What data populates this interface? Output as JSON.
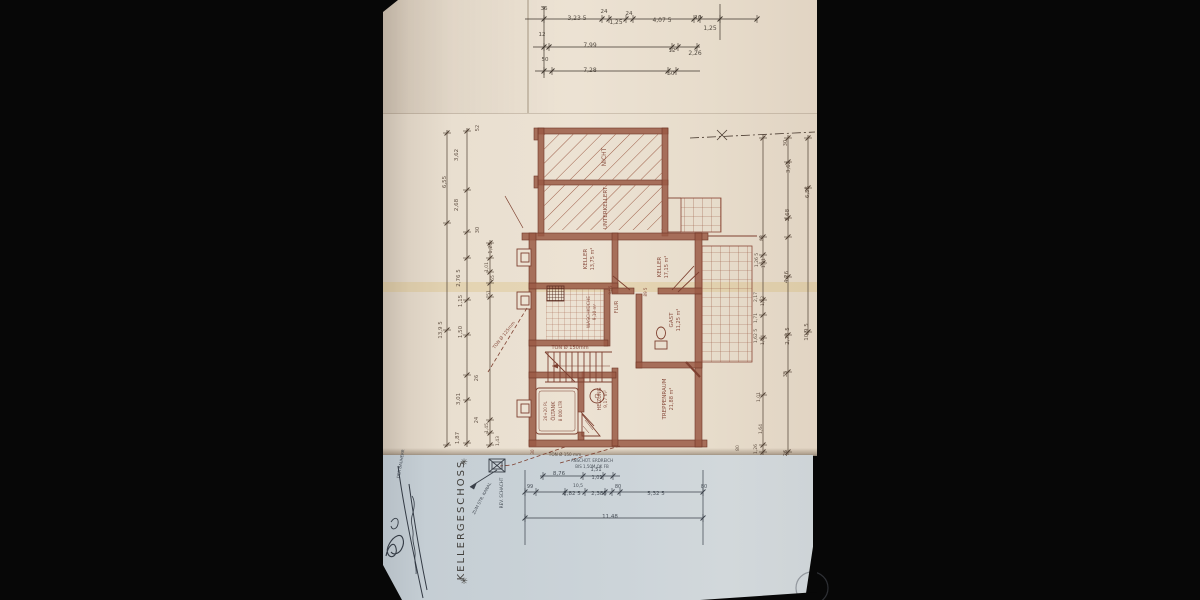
{
  "scene": {
    "description": "Photograph of a hand-drawn basement floor plan (Kellergeschoss), drawing rotated 90 degrees on the sheet",
    "paper_color": "#e9dfd0",
    "lower_sheet_color": "#ccd4d9",
    "plan_ink_color": "#8a4636",
    "dimension_ink_color": "#4e3e31",
    "lower_ink_color": "#383f48",
    "background_color": "#070707"
  },
  "plan": {
    "title": "KELLERGESCHOSS",
    "star": "✳",
    "rooms_summary": [
      {
        "label": "NICHT UNTERKELLERT",
        "note": "two hatched unexcavated areas"
      },
      {
        "label": "KELLER",
        "area": "13,75 m²"
      },
      {
        "label": "KELLER",
        "area": "17,15 m²"
      },
      {
        "label": "WASCHKÜCHE",
        "area": "9,10 m²"
      },
      {
        "label": "FLUR"
      },
      {
        "label": "GAST",
        "area": "11,25 m²"
      },
      {
        "label": "TREPPENRAUM",
        "area": "21,88 m²"
      },
      {
        "label": "HEIZUNG",
        "area": "9,17 m²"
      },
      {
        "label": "ÖLTANK",
        "note": "8 000 LTR"
      }
    ],
    "labels": [
      {
        "t": "36",
        "x": 544,
        "y": 10,
        "k": "top",
        "s": 5.5
      },
      {
        "t": "3,23 5",
        "x": 577,
        "y": 20,
        "k": "top",
        "s": 6
      },
      {
        "t": "24",
        "x": 604,
        "y": 13,
        "k": "top",
        "s": 5.5
      },
      {
        "t": "1,25",
        "x": 616,
        "y": 24,
        "k": "top",
        "s": 6
      },
      {
        "t": "24",
        "x": 629,
        "y": 15,
        "k": "top",
        "s": 5.5
      },
      {
        "t": "4,07 5",
        "x": 662,
        "y": 22,
        "k": "top",
        "s": 6
      },
      {
        "t": "10",
        "x": 698,
        "y": 19,
        "k": "top",
        "s": 5.5
      },
      {
        "t": "1,25",
        "x": 710,
        "y": 30,
        "k": "top",
        "s": 6
      },
      {
        "t": "12",
        "x": 542,
        "y": 36,
        "k": "top",
        "s": 5.5
      },
      {
        "t": "7,99",
        "x": 590,
        "y": 47,
        "k": "top",
        "s": 6
      },
      {
        "t": "12",
        "x": 672,
        "y": 52,
        "k": "top",
        "s": 5.5
      },
      {
        "t": "2,26",
        "x": 695,
        "y": 55,
        "k": "top",
        "s": 6
      },
      {
        "t": "50",
        "x": 545,
        "y": 61,
        "k": "top",
        "s": 5.5
      },
      {
        "t": "7,28",
        "x": 590,
        "y": 72,
        "k": "top",
        "s": 6
      },
      {
        "t": "50",
        "x": 671,
        "y": 75,
        "k": "top",
        "s": 5.5
      },
      {
        "t": "52",
        "x": 479,
        "y": 128,
        "r": -90,
        "k": "dim",
        "s": 5
      },
      {
        "t": "3,62",
        "x": 458,
        "y": 155,
        "r": -90,
        "k": "dim",
        "s": 5.5
      },
      {
        "t": "6,55",
        "x": 446,
        "y": 182,
        "r": -90,
        "k": "dim",
        "s": 5.5
      },
      {
        "t": "2,68",
        "x": 458,
        "y": 205,
        "r": -90,
        "k": "dim",
        "s": 5.5
      },
      {
        "t": "30",
        "x": 479,
        "y": 230,
        "r": -90,
        "k": "dim",
        "s": 5
      },
      {
        "t": "1,25",
        "x": 492,
        "y": 248,
        "r": -90,
        "k": "dim",
        "s": 5
      },
      {
        "t": "1,01",
        "x": 488,
        "y": 267,
        "r": -90,
        "k": "dim",
        "s": 4.5
      },
      {
        "t": "65",
        "x": 494,
        "y": 278,
        "r": -90,
        "k": "dim",
        "s": 4.5
      },
      {
        "t": "2,76 5",
        "x": 460,
        "y": 278,
        "r": -90,
        "k": "dim",
        "s": 5.5
      },
      {
        "t": "51",
        "x": 490,
        "y": 293,
        "r": -90,
        "k": "dim",
        "s": 4.5
      },
      {
        "t": "1,15",
        "x": 462,
        "y": 301,
        "r": -90,
        "k": "dim",
        "s": 5.5
      },
      {
        "t": "13,9 5",
        "x": 442,
        "y": 330,
        "r": -90,
        "k": "dim",
        "s": 5.5
      },
      {
        "t": "1,50",
        "x": 462,
        "y": 332,
        "r": -90,
        "k": "dim",
        "s": 5.5
      },
      {
        "t": "26",
        "x": 478,
        "y": 378,
        "r": -90,
        "k": "dim",
        "s": 5
      },
      {
        "t": "3,01",
        "x": 460,
        "y": 399,
        "r": -90,
        "k": "dim",
        "s": 5.5
      },
      {
        "t": "24",
        "x": 478,
        "y": 420,
        "r": -90,
        "k": "dim",
        "s": 5
      },
      {
        "t": "1,87",
        "x": 459,
        "y": 438,
        "r": -90,
        "k": "dim",
        "s": 5.5
      },
      {
        "t": "1,45",
        "x": 488,
        "y": 428,
        "r": -90,
        "k": "dim",
        "s": 4.5
      },
      {
        "t": "1,43",
        "x": 499,
        "y": 441,
        "r": -90,
        "k": "dim",
        "s": 4.5
      },
      {
        "t": "30",
        "x": 787,
        "y": 143,
        "r": -90,
        "k": "dim",
        "s": 5
      },
      {
        "t": "3,62",
        "x": 790,
        "y": 167,
        "r": -90,
        "k": "dim",
        "s": 5.5
      },
      {
        "t": "6,55",
        "x": 809,
        "y": 192,
        "r": -90,
        "k": "dim",
        "s": 5.5
      },
      {
        "t": "2,68",
        "x": 789,
        "y": 215,
        "r": -90,
        "k": "dim",
        "s": 5.5
      },
      {
        "t": "88",
        "x": 763,
        "y": 238,
        "r": -90,
        "k": "dim",
        "s": 4.5
      },
      {
        "t": "1,26 5",
        "x": 758,
        "y": 260,
        "r": -90,
        "k": "dim",
        "s": 4.5
      },
      {
        "t": "1,31",
        "x": 765,
        "y": 263,
        "r": -90,
        "k": "dim",
        "s": 4.5
      },
      {
        "t": "4,26",
        "x": 788,
        "y": 277,
        "r": -90,
        "k": "dim",
        "s": 5.5
      },
      {
        "t": "2,17",
        "x": 757,
        "y": 297,
        "r": -90,
        "k": "dim",
        "s": 4.5
      },
      {
        "t": "1,32",
        "x": 764,
        "y": 301,
        "r": -90,
        "k": "dim",
        "s": 4.5
      },
      {
        "t": "1,71",
        "x": 757,
        "y": 318,
        "r": -90,
        "k": "dim",
        "s": 4.5
      },
      {
        "t": "1,62 5",
        "x": 757,
        "y": 336,
        "r": -90,
        "k": "dim",
        "s": 4.5
      },
      {
        "t": "1,04",
        "x": 764,
        "y": 340,
        "r": -90,
        "k": "dim",
        "s": 4.5
      },
      {
        "t": "2,78 5",
        "x": 789,
        "y": 336,
        "r": -90,
        "k": "dim",
        "s": 5.5
      },
      {
        "t": "10,9 5",
        "x": 808,
        "y": 332,
        "r": -90,
        "k": "dim",
        "s": 5.5
      },
      {
        "t": "35",
        "x": 787,
        "y": 374,
        "r": -90,
        "k": "dim",
        "s": 5
      },
      {
        "t": "1,01",
        "x": 760,
        "y": 397,
        "r": -90,
        "k": "dim",
        "s": 4.5
      },
      {
        "t": "1,64",
        "x": 762,
        "y": 429,
        "r": -90,
        "k": "dim",
        "s": 4.5
      },
      {
        "t": "1,26",
        "x": 757,
        "y": 449,
        "r": -90,
        "k": "dim",
        "s": 4.5
      },
      {
        "t": "26",
        "x": 787,
        "y": 453,
        "r": -90,
        "k": "dim",
        "s": 5
      },
      {
        "t": "80",
        "x": 739,
        "y": 448,
        "r": -90,
        "k": "dim",
        "s": 4.5
      },
      {
        "t": "NICHT",
        "x": 606,
        "y": 157,
        "r": -90,
        "k": "plan",
        "s": 6,
        "n": "room-label-nicht"
      },
      {
        "t": "UNTERKELLERT",
        "x": 607,
        "y": 208,
        "r": -90,
        "k": "plan",
        "s": 5.5,
        "n": "room-label-unterkellert"
      },
      {
        "t": "KELLER",
        "x": 587,
        "y": 259,
        "r": -90,
        "k": "plan",
        "s": 5.5,
        "n": "room-label-keller-1"
      },
      {
        "t": "13,75 m²",
        "x": 594,
        "y": 259,
        "r": -90,
        "k": "plan",
        "s": 5
      },
      {
        "t": "KELLER",
        "x": 661,
        "y": 267,
        "r": -90,
        "k": "plan",
        "s": 5.5,
        "n": "room-label-keller-2"
      },
      {
        "t": "17,15 m²",
        "x": 668,
        "y": 267,
        "r": -90,
        "k": "plan",
        "s": 5
      },
      {
        "t": "WASCHKÜCHE",
        "x": 590,
        "y": 312,
        "r": -90,
        "k": "plan",
        "s": 4.5,
        "n": "room-label-waschkueche"
      },
      {
        "t": "9,10 m²",
        "x": 596,
        "y": 312,
        "r": -90,
        "k": "plan",
        "s": 4.2
      },
      {
        "t": "FLUR",
        "x": 618,
        "y": 307,
        "r": -90,
        "k": "plan",
        "s": 5,
        "n": "room-label-flur"
      },
      {
        "t": "94 5",
        "x": 612,
        "y": 290,
        "r": -90,
        "k": "plan",
        "s": 4
      },
      {
        "t": "89 5",
        "x": 647,
        "y": 292,
        "r": -90,
        "k": "plan",
        "s": 4
      },
      {
        "t": "GAST",
        "x": 673,
        "y": 320,
        "r": -90,
        "k": "plan",
        "s": 5.5,
        "n": "room-label-gast"
      },
      {
        "t": "11,25 m²",
        "x": 680,
        "y": 320,
        "r": -90,
        "k": "plan",
        "s": 5
      },
      {
        "t": "TREPPENRAUM",
        "x": 666,
        "y": 399,
        "r": -90,
        "k": "plan",
        "s": 5.5,
        "n": "room-label-treppenraum"
      },
      {
        "t": "21,88 m²",
        "x": 673,
        "y": 399,
        "r": -90,
        "k": "plan",
        "s": 5
      },
      {
        "t": "26+20 PL",
        "x": 547,
        "y": 411,
        "r": -90,
        "k": "plan",
        "s": 4
      },
      {
        "t": "ÖLTANK",
        "x": 555,
        "y": 411,
        "r": -90,
        "k": "plan",
        "s": 5,
        "n": "room-label-oeltank"
      },
      {
        "t": "8 000 LTR",
        "x": 562,
        "y": 411,
        "r": -90,
        "k": "plan",
        "s": 4.2
      },
      {
        "t": "HEIZUNG",
        "x": 601,
        "y": 399,
        "r": -90,
        "k": "plan",
        "s": 5,
        "n": "room-label-heizung"
      },
      {
        "t": "9,17 m²",
        "x": 607,
        "y": 399,
        "r": -90,
        "k": "plan",
        "s": 4.5
      },
      {
        "t": "TON Ø 150mm",
        "x": 570,
        "y": 349,
        "k": "plan",
        "s": 5,
        "n": "drain-note"
      },
      {
        "t": "TON Ø 150 mm",
        "x": 565,
        "y": 456,
        "k": "dim",
        "s": 4.2,
        "n": "drain-note"
      },
      {
        "t": "TON Ø 125mm",
        "x": 505,
        "y": 336,
        "r": -52,
        "k": "plan",
        "s": 4.5,
        "n": "drain-note"
      },
      {
        "t": "30",
        "x": 534,
        "y": 452,
        "r": -90,
        "k": "plan",
        "s": 4
      },
      {
        "t": "ANSCHÜT. ERDREICH",
        "x": 592,
        "y": 462,
        "k": "blue",
        "s": 4
      },
      {
        "t": "BIS 1,50M  OK FB",
        "x": 592,
        "y": 468,
        "k": "blue",
        "s": 4
      },
      {
        "t": "8,76",
        "x": 559,
        "y": 475,
        "k": "blue",
        "s": 5.5
      },
      {
        "t": "1,51",
        "x": 596,
        "y": 471,
        "k": "blue",
        "s": 5
      },
      {
        "t": "1,01",
        "x": 597,
        "y": 479,
        "k": "blue",
        "s": 5
      },
      {
        "t": "99",
        "x": 530,
        "y": 488,
        "k": "blue",
        "s": 5
      },
      {
        "t": "10,5",
        "x": 578,
        "y": 487,
        "k": "blue",
        "s": 4.5
      },
      {
        "t": "2,82 5",
        "x": 572,
        "y": 495,
        "k": "blue",
        "s": 5.5
      },
      {
        "t": "2,385",
        "x": 599,
        "y": 495,
        "k": "blue",
        "s": 5.5
      },
      {
        "t": "80",
        "x": 618,
        "y": 488,
        "k": "blue",
        "s": 5
      },
      {
        "t": "5,32 5",
        "x": 656,
        "y": 495,
        "k": "blue",
        "s": 5.5
      },
      {
        "t": "80",
        "x": 704,
        "y": 488,
        "k": "blue",
        "s": 5
      },
      {
        "t": "11,48",
        "x": 610,
        "y": 518,
        "k": "blue",
        "s": 5.5
      },
      {
        "t": "REV. SCHACHT",
        "x": 503,
        "y": 493,
        "r": -90,
        "k": "blue",
        "s": 4.2,
        "n": "rev-schacht-label"
      },
      {
        "t": "ZUM STR. KANAL",
        "x": 483,
        "y": 499,
        "r": -62,
        "k": "blue",
        "s": 4.2,
        "n": "kanal-label"
      },
      {
        "t": "DER BAUHERR",
        "x": 402,
        "y": 464,
        "r": -80,
        "k": "hand",
        "s": 4,
        "n": "bauherr-label"
      }
    ]
  }
}
